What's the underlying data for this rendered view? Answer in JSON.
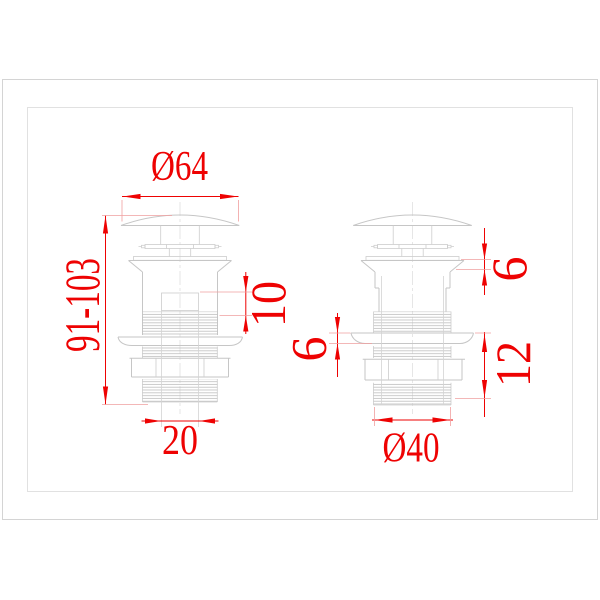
{
  "image": {
    "type": "technical dimension drawing",
    "subject": "pop-up click-clack basin waste drain, two side views with red dimensions"
  },
  "colors": {
    "background": "#ffffff",
    "dimension_red": "#ee0202",
    "outline_gray": "#c6c6c6",
    "frame_gray": "#d4d4d4"
  },
  "dimensions": {
    "left_view": {
      "cap_diameter": "Ø64",
      "overall_height": "91-103",
      "overflow_section": "10",
      "outlet_bore": "20"
    },
    "right_view": {
      "cap_body_gap": "6",
      "flange_thickness": "6",
      "mount_section": "12",
      "thread_diameter": "Ø40"
    }
  }
}
